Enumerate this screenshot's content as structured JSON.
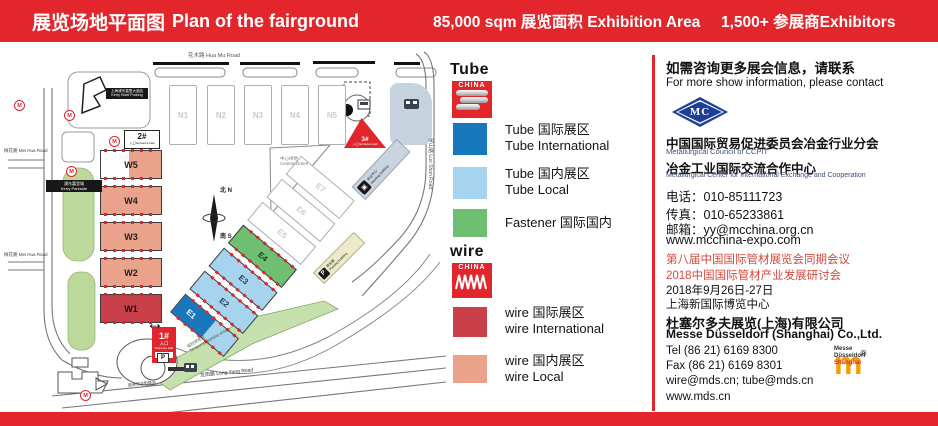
{
  "banner": {
    "title_zh": "展览场地平面图",
    "title_en": "Plan of the fairground",
    "stat_area": "85,000 sqm 展览面积 Exhibition Area",
    "stat_exhibitors": "1,500+ 参展商Exhibitors"
  },
  "colors": {
    "banner_red": "#E2262C",
    "tube_international": "#1779BC",
    "tube_local": "#A6D3EE",
    "fastener": "#6FBF73",
    "wire_international": "#C9404A",
    "wire_local": "#EBA28B",
    "mc_blue": "#1C3F97",
    "messe_orange": "#F59C00"
  },
  "map": {
    "roads": {
      "huamu": "花木路 Hua Mu Road",
      "luoshan": "罗山路 Luo Shan Road",
      "longyang": "龙阳路 Long Yang Road",
      "meihua_1": "梅花路 Mei Hua Road",
      "meihua_2": "梅花路 Mei Hua Road"
    },
    "places": {
      "kerry_hotel_zh": "上海浦东嘉里大酒店",
      "kerry_hotel_en": "Kerry Hotel Pudong",
      "kerry_parkside_zh": "浦东嘉里城",
      "kerry_parkside_en": "Kerry Parkside",
      "central_green_zh": "中心绿地",
      "central_green_en": "Central Green",
      "meeting_zh": "会议中心",
      "meeting_en": "Meeting building",
      "parking_zh": "停车楼",
      "parking_en": "Parking building",
      "temp_parking_zh": "临时停车区",
      "temp_parking_en": "Temporary parking area",
      "maglev": "磁悬浮龙阳路站"
    },
    "entrances": {
      "e1": {
        "num": "1#",
        "zh": "入口",
        "en": "Entrance Hall"
      },
      "e2": {
        "num": "2#",
        "zh": "入口",
        "en": "Entrance Hall"
      },
      "e3": {
        "num": "3#",
        "zh": "入口",
        "en": "Entrance Hall"
      }
    },
    "compass": {
      "north": "北 N",
      "south": "南 S"
    },
    "metro_label": "M",
    "parking_p": "P",
    "halls": {
      "north": [
        {
          "id": "N1"
        },
        {
          "id": "N2"
        },
        {
          "id": "N3"
        },
        {
          "id": "N4"
        },
        {
          "id": "N5"
        }
      ],
      "west": [
        {
          "id": "W5"
        },
        {
          "id": "W4"
        },
        {
          "id": "W3"
        },
        {
          "id": "W2"
        },
        {
          "id": "W1"
        }
      ],
      "east": [
        {
          "id": "E1"
        },
        {
          "id": "E2"
        },
        {
          "id": "E3"
        },
        {
          "id": "E4"
        },
        {
          "id": "E5"
        },
        {
          "id": "E6"
        },
        {
          "id": "E7"
        }
      ]
    }
  },
  "legend": {
    "tube_logo": {
      "word": "Tube",
      "sub": "CHINA"
    },
    "wire_logo": {
      "word": "wire",
      "sub": "CHINA"
    },
    "items": [
      {
        "line1": "Tube 国际展区",
        "line2": "Tube International",
        "color": "#1779BC"
      },
      {
        "line1": "Tube 国内展区",
        "line2": "Tube Local",
        "color": "#A6D3EE"
      },
      {
        "line1": "Fastener 国际国内",
        "line2": "",
        "color": "#6FBF73"
      },
      {
        "line1": "wire 国际展区",
        "line2": "wire International",
        "color": "#C9404A"
      },
      {
        "line1": "wire 国内展区",
        "line2": "wire Local",
        "color": "#EBA28B"
      }
    ]
  },
  "contact": {
    "heading_zh": "如需咨询更多展会信息，请联系",
    "heading_en": "For more show information, please contact",
    "mc_logo": "MC",
    "org1_zh": "中国国际贸易促进委员会冶金行业分会",
    "org1_en": "Metallurgical Council of CCPIT",
    "org2_zh": "冶金工业国际交流合作中心",
    "org2_en": "Metallurgical Center for International Exchange and Cooperation",
    "tel": "电话：010-85111723",
    "fax": "传真：010-65233861",
    "email": "邮箱：yy@mcchina.org.cn",
    "web": "www.mcchina-expo.com",
    "conf1": "第八届中国国际管材展览会同期会议",
    "conf2": "2018中国国际管材产业发展研讨会",
    "conf_date": "2018年9月26日-27日",
    "conf_venue": "上海新国际博览中心",
    "md_zh": "杜塞尔多夫展览(上海)有限公司",
    "md_en": "Messe Düsseldorf (Shanghai) Co.,Ltd.",
    "md_tel": "Tel  (86 21) 6169 8300",
    "md_fax": "Fax (86 21) 6169 8301",
    "md_email": "wire@mds.cn; tube@mds.cn",
    "md_web": "www.mds.cn",
    "md_logo": {
      "mark": "m",
      "reg": "®",
      "cap1": "Messe",
      "cap2": "Düsseldorf",
      "cap3": "Shanghai"
    }
  }
}
